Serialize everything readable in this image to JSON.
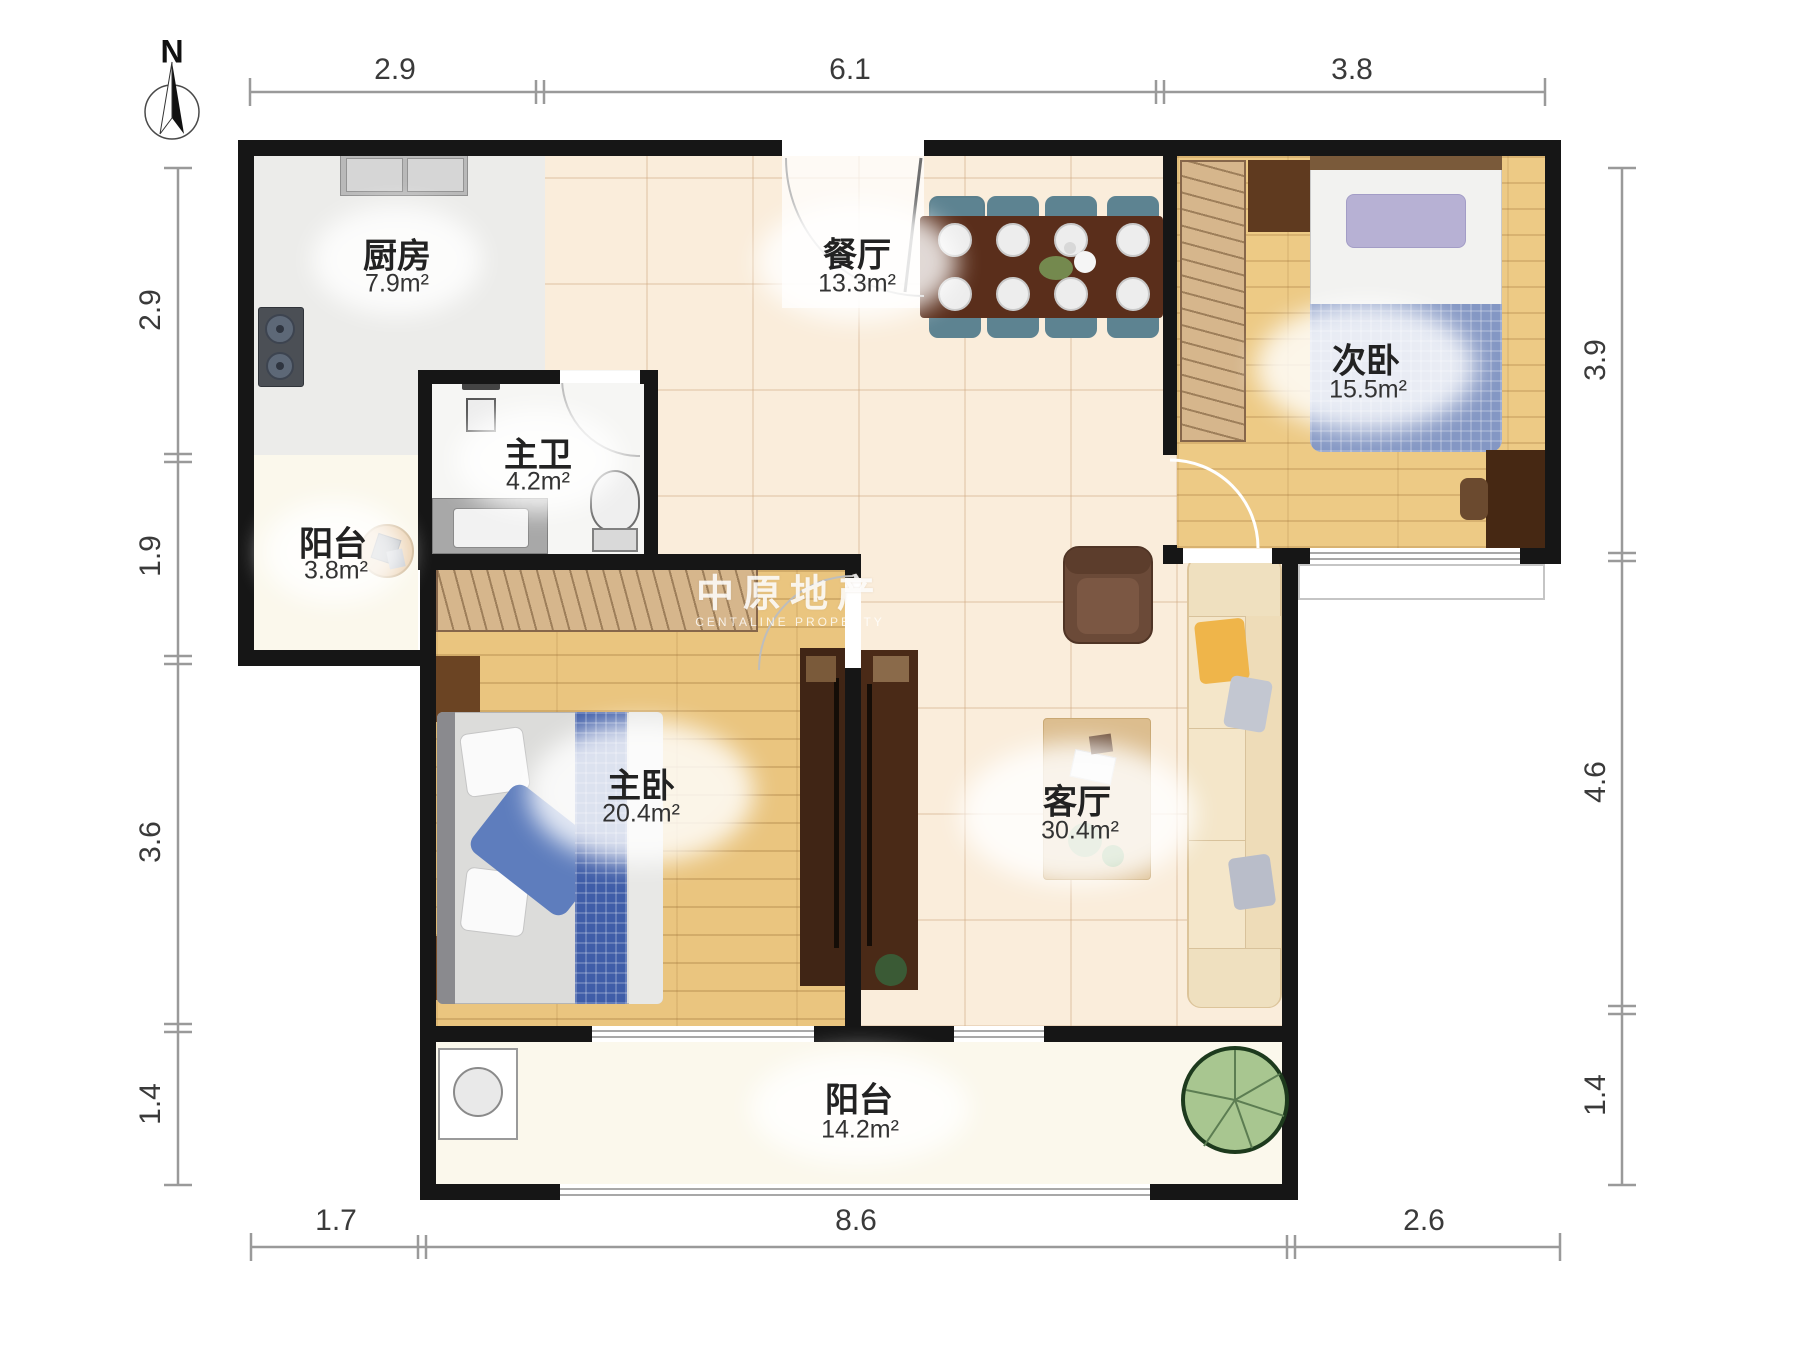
{
  "compass": {
    "label": "N"
  },
  "watermark": {
    "title": "中原地产",
    "subtitle": "CENTALINE PROPERTY"
  },
  "rooms": {
    "kitchen": {
      "name": "厨房",
      "area": "7.9m²"
    },
    "dining": {
      "name": "餐厅",
      "area": "13.3m²"
    },
    "second_bedroom": {
      "name": "次卧",
      "area": "15.5m²"
    },
    "master_bath": {
      "name": "主卫",
      "area": "4.2m²"
    },
    "balcony_small": {
      "name": "阳台",
      "area": "3.8m²"
    },
    "master_bedroom": {
      "name": "主卧",
      "area": "20.4m²"
    },
    "living": {
      "name": "客厅",
      "area": "30.4m²"
    },
    "balcony_large": {
      "name": "阳台",
      "area": "14.2m²"
    }
  },
  "dims": {
    "top": [
      "2.9",
      "6.1",
      "3.8"
    ],
    "left": [
      "2.9",
      "1.9",
      "3.6",
      "1.4"
    ],
    "right": [
      "3.9",
      "4.6",
      "1.4"
    ],
    "bottom": [
      "1.7",
      "8.6",
      "2.6"
    ]
  },
  "colors": {
    "wall": "#161616",
    "tile_floor": "#faeddb",
    "wood_floor": "#eac57f",
    "kitchen_floor": "#ececea",
    "balcony_floor": "#fbf8ec",
    "dining_chair": "#5d8391",
    "dining_table": "#5a2e1b",
    "sofa": "#f4e6c9",
    "armchair": "#6b4a38",
    "bed_blanket_blue": "#3f5da8",
    "plant_green": "#a8c690",
    "dimension_line": "#9a9a9a"
  },
  "furniture_icons": [
    "north-compass-icon",
    "sink-icon",
    "stove-icon",
    "shower-icon",
    "toilet-icon",
    "washbasin-icon",
    "dining-table-icon",
    "dining-chair-icon",
    "plate-icon",
    "wardrobe-icon",
    "bed-icon",
    "pillow-icon",
    "desk-icon",
    "tv-cabinet-icon",
    "sofa-icon",
    "armchair-icon",
    "coffee-table-icon",
    "washing-machine-icon",
    "plant-icon",
    "basket-icon",
    "door-arc-icon",
    "window-icon"
  ]
}
